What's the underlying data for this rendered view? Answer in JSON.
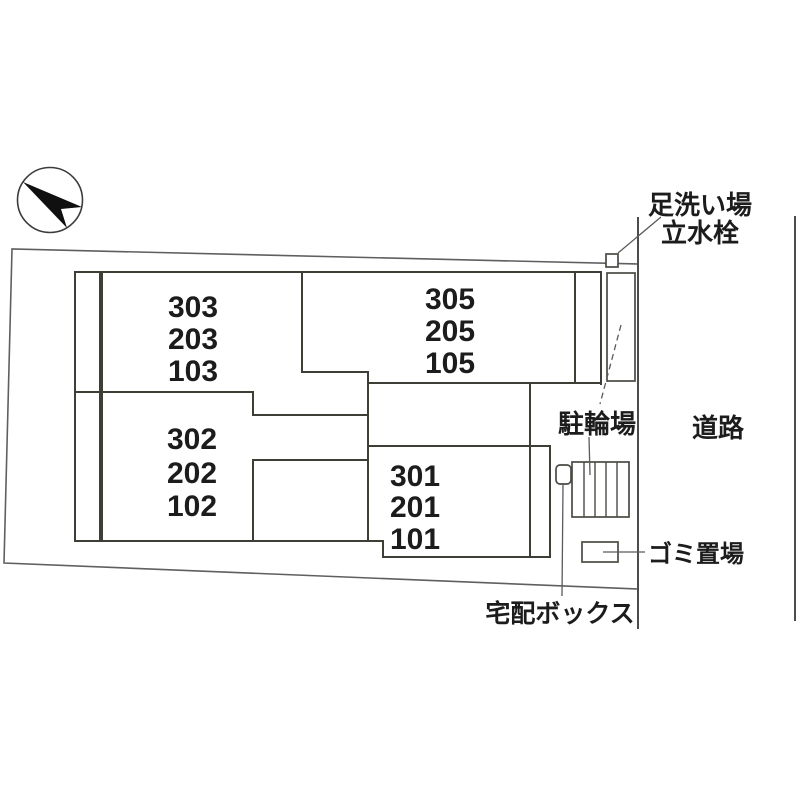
{
  "site": {
    "labels": {
      "foot_wash_line1": "足洗い場",
      "foot_wash_line2": "立水栓",
      "road": "道路",
      "bicycle_parking": "駐輪場",
      "garbage_area": "ゴミ置場",
      "delivery_box": "宅配ボックス"
    },
    "rooms": [
      {
        "position": "upper-left",
        "units": [
          "303",
          "203",
          "103"
        ]
      },
      {
        "position": "upper-right",
        "units": [
          "305",
          "205",
          "105"
        ]
      },
      {
        "position": "lower-left",
        "units": [
          "302",
          "202",
          "102"
        ]
      },
      {
        "position": "lower-right",
        "units": [
          "301",
          "201",
          "101"
        ]
      }
    ],
    "colors": {
      "room_fill": "#FBF7C9",
      "wall": "#3e3e36",
      "boundary": "#5f5f5f",
      "text": "#1c1c1c"
    },
    "icons": {
      "compass": "north-arrow-icon"
    }
  }
}
